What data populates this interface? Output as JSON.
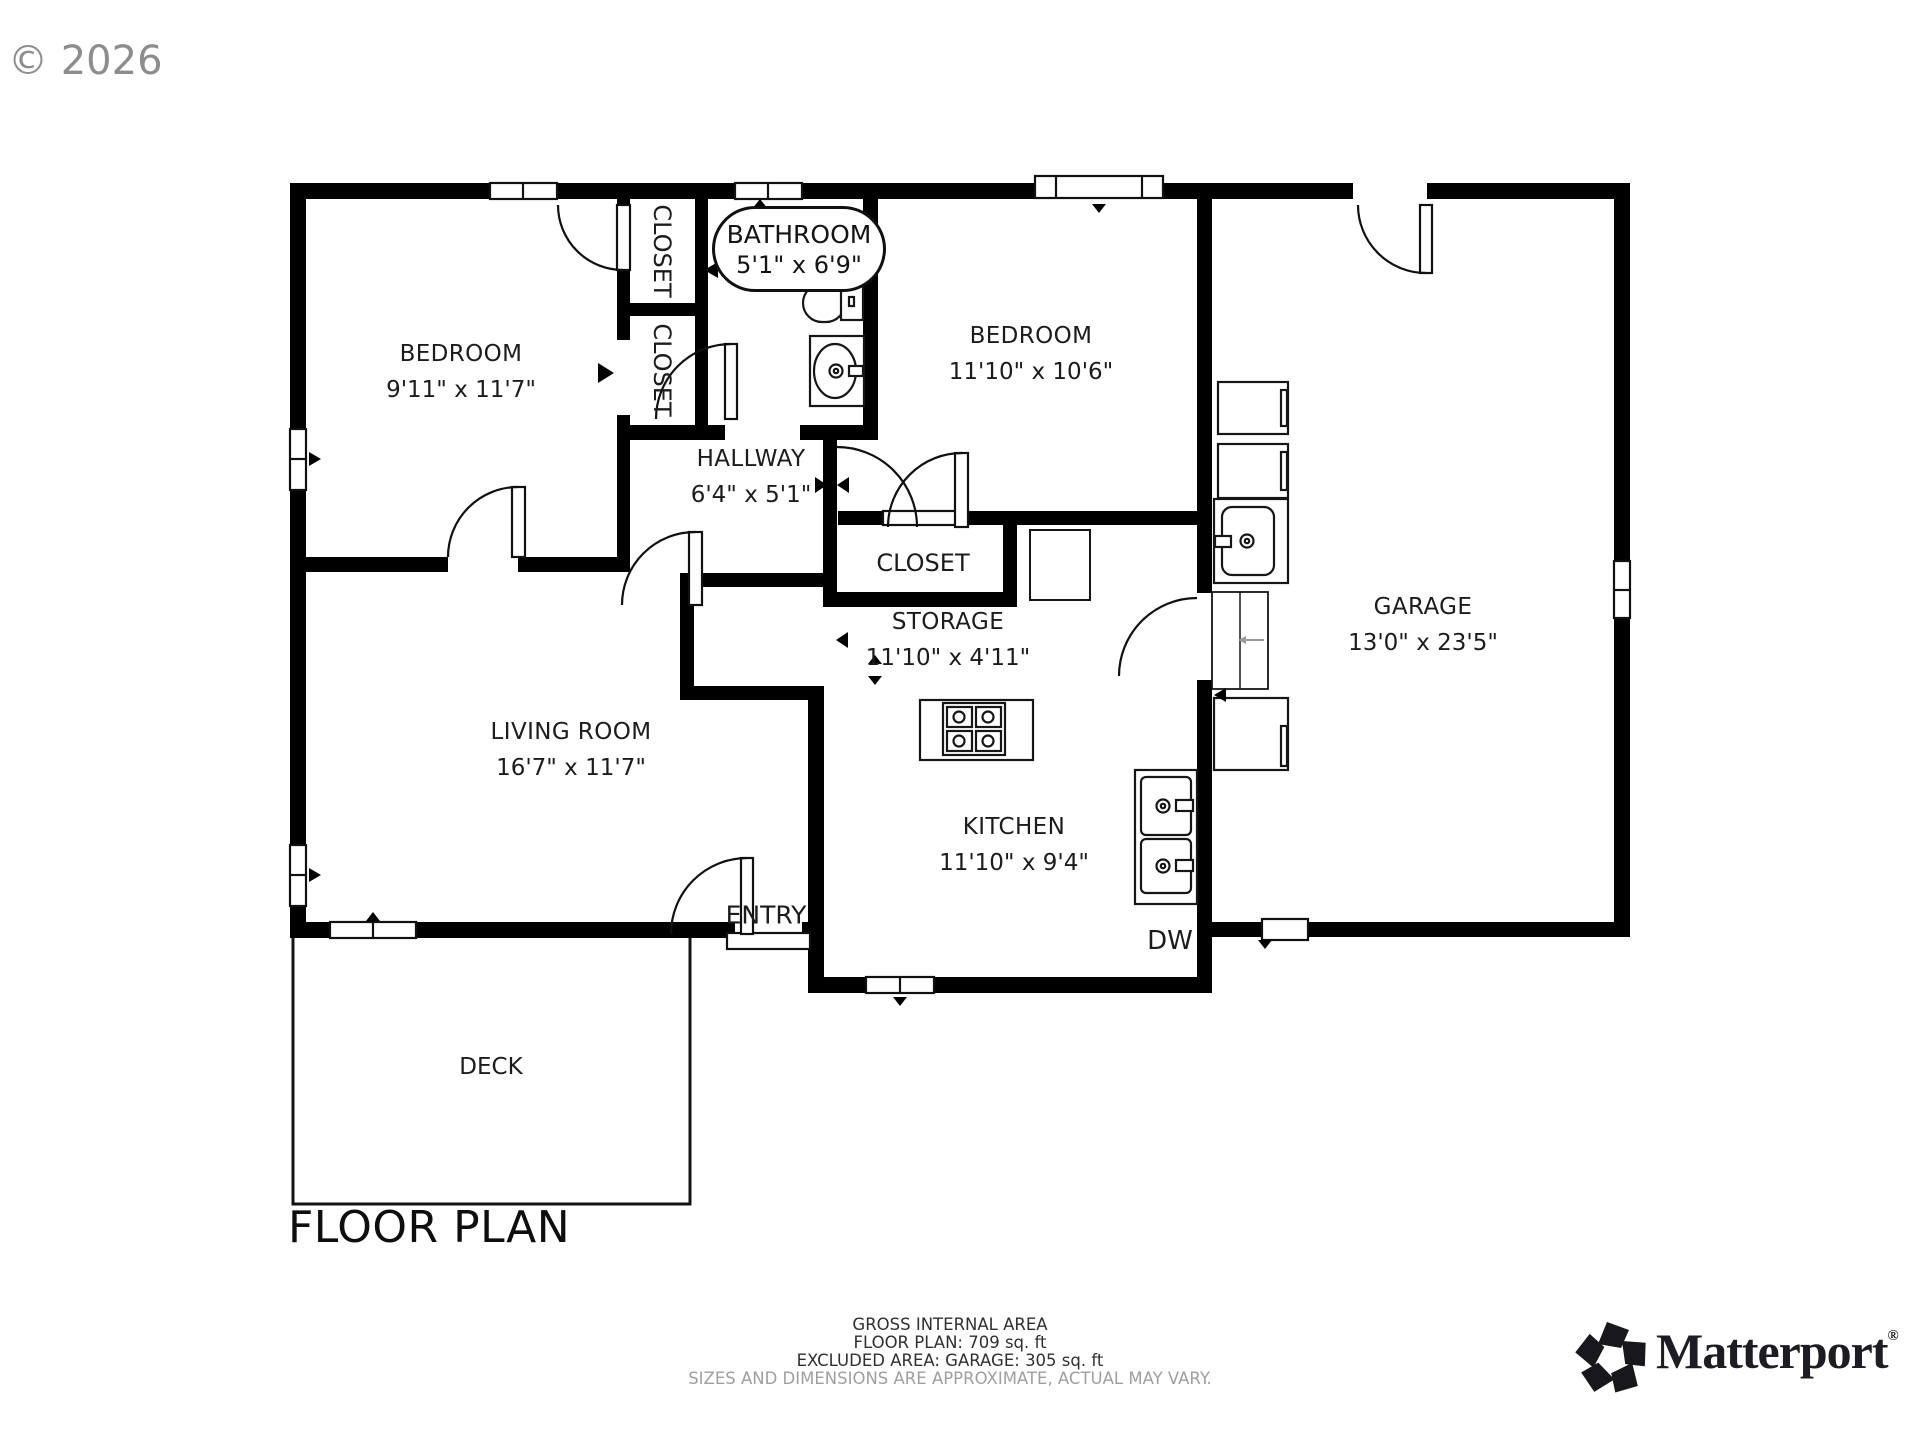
{
  "copyright": "© 2026",
  "title": "FLOOR PLAN",
  "rooms": {
    "bedroom1": {
      "name": "BEDROOM",
      "dims": "9'11\" x 11'7\""
    },
    "bedroom2": {
      "name": "BEDROOM",
      "dims": "11'10\" x 10'6\""
    },
    "bathroom": {
      "name": "BATHROOM",
      "dims": "5'1\" x 6'9\""
    },
    "hallway": {
      "name": "HALLWAY",
      "dims": "6'4\" x 5'1\""
    },
    "storage": {
      "name": "STORAGE",
      "dims": "11'10\" x 4'11\""
    },
    "garage": {
      "name": "GARAGE",
      "dims": "13'0\" x 23'5\""
    },
    "living_room": {
      "name": "LIVING ROOM",
      "dims": "16'7\" x 11'7\""
    },
    "kitchen": {
      "name": "KITCHEN",
      "dims": "11'10\" x 9'4\""
    },
    "closet_top": {
      "name": "CLOSET"
    },
    "closet_mid": {
      "name": "CLOSET"
    },
    "closet_hall": {
      "name": "CLOSET"
    },
    "entry": {
      "name": "ENTRY"
    },
    "deck": {
      "name": "DECK"
    },
    "dishwasher": {
      "name": "DW"
    }
  },
  "footer": {
    "line1": "GROSS INTERNAL AREA",
    "line2": "FLOOR PLAN: 709 sq. ft",
    "line3": "EXCLUDED AREA: GARAGE: 305 sq. ft",
    "line4": "SIZES AND DIMENSIONS ARE APPROXIMATE, ACTUAL MAY VARY."
  },
  "brand": {
    "name": "Matterport",
    "registered": "®"
  },
  "colors": {
    "wall": "#000000",
    "line": "#111111",
    "muted_text": "#9f9f9f",
    "watermark": "#8d8d8d"
  }
}
